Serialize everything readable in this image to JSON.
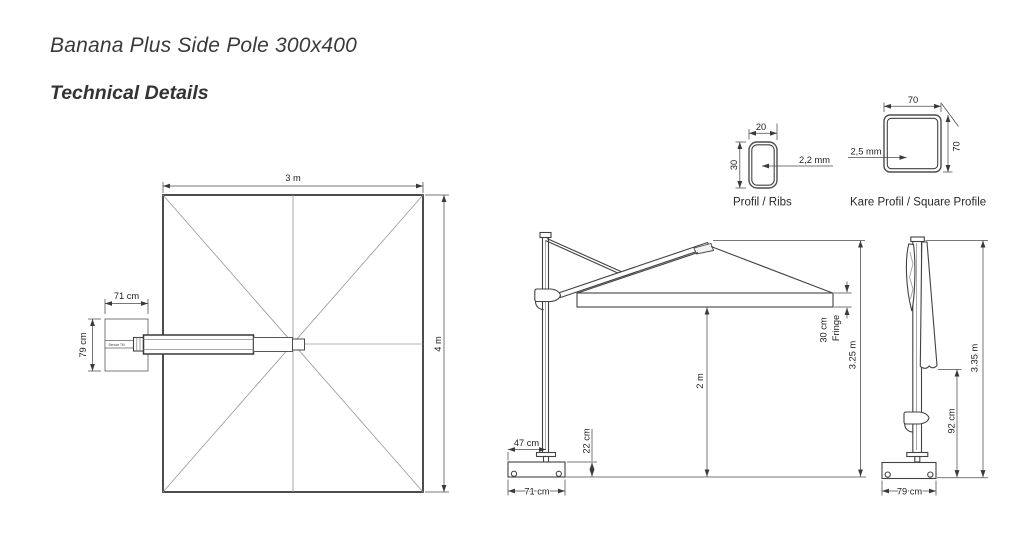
{
  "header": {
    "title": "Banana Plus Side Pole 300x400",
    "subtitle": "Technical Details"
  },
  "colors": {
    "ink": "#3a3a3a",
    "light_line": "#9b9b9b",
    "text": "#1e1e1e",
    "background": "#ffffff"
  },
  "top_view": {
    "canopy_width": "3 m",
    "canopy_depth": "4 m",
    "base_offset_width": "71 cm",
    "base_offset_depth": "79 cm",
    "arm_print": "Service TM"
  },
  "open_view": {
    "total_height": "3.25 m",
    "clearance": "2 m",
    "fringe_size": "30 cm",
    "fringe_word": "Fringe",
    "base_height": "22 cm",
    "pole_inset": "47 cm",
    "base_width": "71 cm"
  },
  "closed_view": {
    "total_height": "3.35 m",
    "canopy_clearance": "92 cm",
    "base_width": "79 cm"
  },
  "profiles": {
    "rib": {
      "width": "20",
      "height": "30",
      "wall": "2,2 mm",
      "caption": "Profil / Ribs"
    },
    "square": {
      "width": "70",
      "height": "70",
      "wall": "2,5 mm",
      "caption": "Kare Profil / Square Profile"
    }
  }
}
